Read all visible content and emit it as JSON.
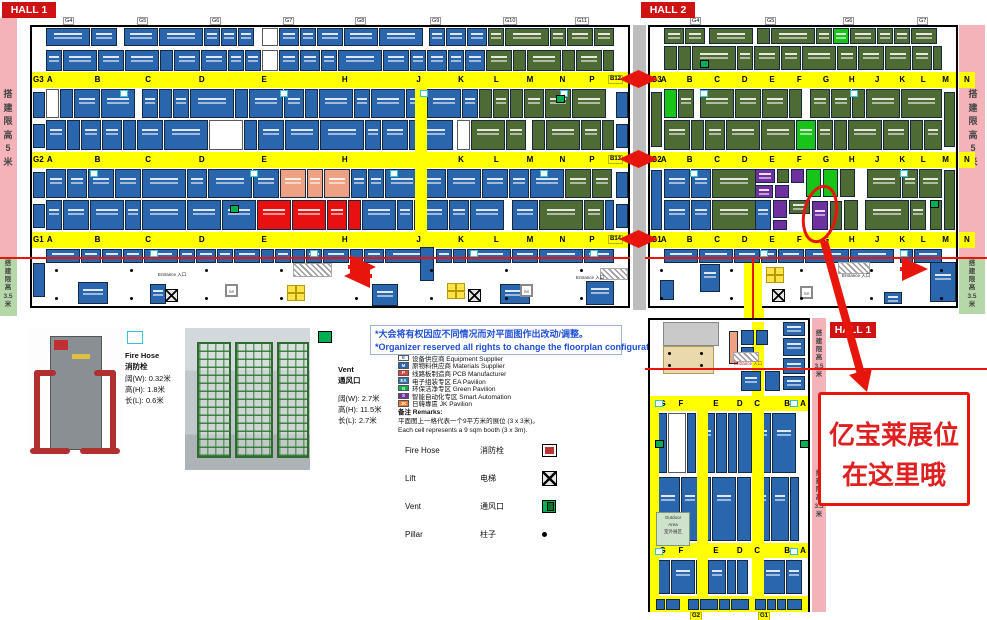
{
  "colors": {
    "booth_blue": "#2a66ae",
    "booth_olive": "#4f6b34",
    "booth_green": "#17c417",
    "booth_purple": "#7030a0",
    "booth_red": "#e81010",
    "booth_salmon": "#efa183",
    "aisle_yellow": "#ffff00",
    "strip_pink": "#f3b3b8",
    "strip_green": "#b6d7a8",
    "accent_red": "#e8150d",
    "notice_blue": "#1f4fd8"
  },
  "halls": {
    "hall1": {
      "label": "HALL 1",
      "gates": [
        "G4",
        "G5",
        "G6",
        "G7",
        "G8",
        "G9",
        "G10",
        "G11"
      ],
      "aisles": [
        {
          "left": "G3",
          "right": "B12",
          "letters": [
            "A",
            "B",
            "C",
            "D",
            "E",
            "H",
            "J",
            "K",
            "L",
            "M",
            "N",
            "P",
            "Q"
          ]
        },
        {
          "left": "G2",
          "right": "B13",
          "letters": [
            "A",
            "B",
            "C",
            "D",
            "E",
            "H",
            "J",
            "K",
            "L",
            "M",
            "N",
            "P",
            "Q"
          ]
        },
        {
          "left": "G1",
          "right": "B14",
          "letters": [
            "A",
            "B",
            "C",
            "D",
            "E",
            "H",
            "J",
            "K",
            "L",
            "M",
            "N",
            "P",
            "Q"
          ]
        }
      ],
      "entrance": "Entrance 入口"
    },
    "hall2": {
      "label": "HALL 2",
      "gates": [
        "G4",
        "G5",
        "G6",
        "G7"
      ],
      "aisles": [
        {
          "left": "G3",
          "right": "N",
          "letters": [
            "A",
            "B",
            "C",
            "D",
            "E",
            "F",
            "G",
            "H",
            "J",
            "K",
            "L",
            "M"
          ]
        },
        {
          "left": "G2",
          "right": "N",
          "letters": [
            "A",
            "B",
            "C",
            "D",
            "E",
            "F",
            "G",
            "H",
            "J",
            "K",
            "L",
            "M"
          ]
        },
        {
          "left": "G1",
          "right": "N",
          "letters": [
            "A",
            "B",
            "C",
            "D",
            "E",
            "F",
            "G",
            "H",
            "J",
            "K",
            "L",
            "M"
          ]
        }
      ],
      "entrance": "Entrance 入口"
    },
    "hall3": {
      "label": "HALL 1",
      "rows": [
        [
          "G",
          "F",
          "E",
          "D",
          "C",
          "B",
          "A"
        ],
        [
          "G",
          "F",
          "E",
          "D",
          "C",
          "B",
          "A"
        ]
      ],
      "bottom_gates": [
        "G2",
        "G1"
      ],
      "outdoor": [
        "Outdoor",
        "Area",
        "室外展区"
      ],
      "entrance": "Entrance 入口"
    }
  },
  "strips": {
    "limit_5m": "搭建限高 5 米",
    "limit_3_5m": "搭建限高 3.5 米"
  },
  "notice": {
    "line1": "*大会将有权因应不同情况而对平面图作出改动/调整。",
    "line2": "*Organizer reserved all rights to change the floorplan configurations."
  },
  "legend": {
    "items": [
      {
        "code": "E",
        "bg": "#ffffff",
        "fg": "#2a66ae",
        "label": "设备供应商 Equipment Supplier"
      },
      {
        "code": "M",
        "bg": "#2a66ae",
        "fg": "#ffffff",
        "label": "原物料供应商 Materials Supplier"
      },
      {
        "code": "P",
        "bg": "#e8453c",
        "fg": "#ffffff",
        "label": "线路板制造商 PCB Manufacturer"
      },
      {
        "code": "EA",
        "bg": "#2e75b6",
        "fg": "#ffffff",
        "label": "电子组装专区 EA Pavilion"
      },
      {
        "code": "G",
        "bg": "#00b050",
        "fg": "#ffffff",
        "label": "环保洁净专区 Green Pavilion"
      },
      {
        "code": "S",
        "bg": "#7030a0",
        "fg": "#ffffff",
        "label": "智能自动化专区 Smart Automation"
      },
      {
        "code": "JK",
        "bg": "#ed7d31",
        "fg": "#ffffff",
        "label": "日韓專區 JK Pavilion"
      }
    ]
  },
  "remarks": {
    "title": "备注 Remarks:",
    "line1": "平面图上一格代表一个9平方米的展位 (3 x 3米)。",
    "line2": "Each cell represents a 9 sqm booth (3 x 3m)."
  },
  "symbol_legend": [
    {
      "en": "Fire Hose",
      "zh": "消防栓",
      "icon": "firehose-icon"
    },
    {
      "en": "Lift",
      "zh": "电梯",
      "icon": "lift-icon"
    },
    {
      "en": "Vent",
      "zh": "通风口",
      "icon": "vent-icon"
    },
    {
      "en": "Pillar",
      "zh": "柱子",
      "icon": "pillar-icon"
    }
  ],
  "fire_hose": {
    "en": "Fire Hose",
    "zh": "消防栓",
    "dims": [
      "阔(W): 0.32米",
      "高(H): 1.8米",
      "长(L): 0.6米"
    ]
  },
  "vent": {
    "en": "Vent",
    "zh": "通风口",
    "dims": [
      "阔(W): 2.7米",
      "高(H): 11.5米",
      "长(L): 2.7米"
    ]
  },
  "annotation": {
    "line1": "亿宝莱展位",
    "line2": "在这里哦"
  }
}
